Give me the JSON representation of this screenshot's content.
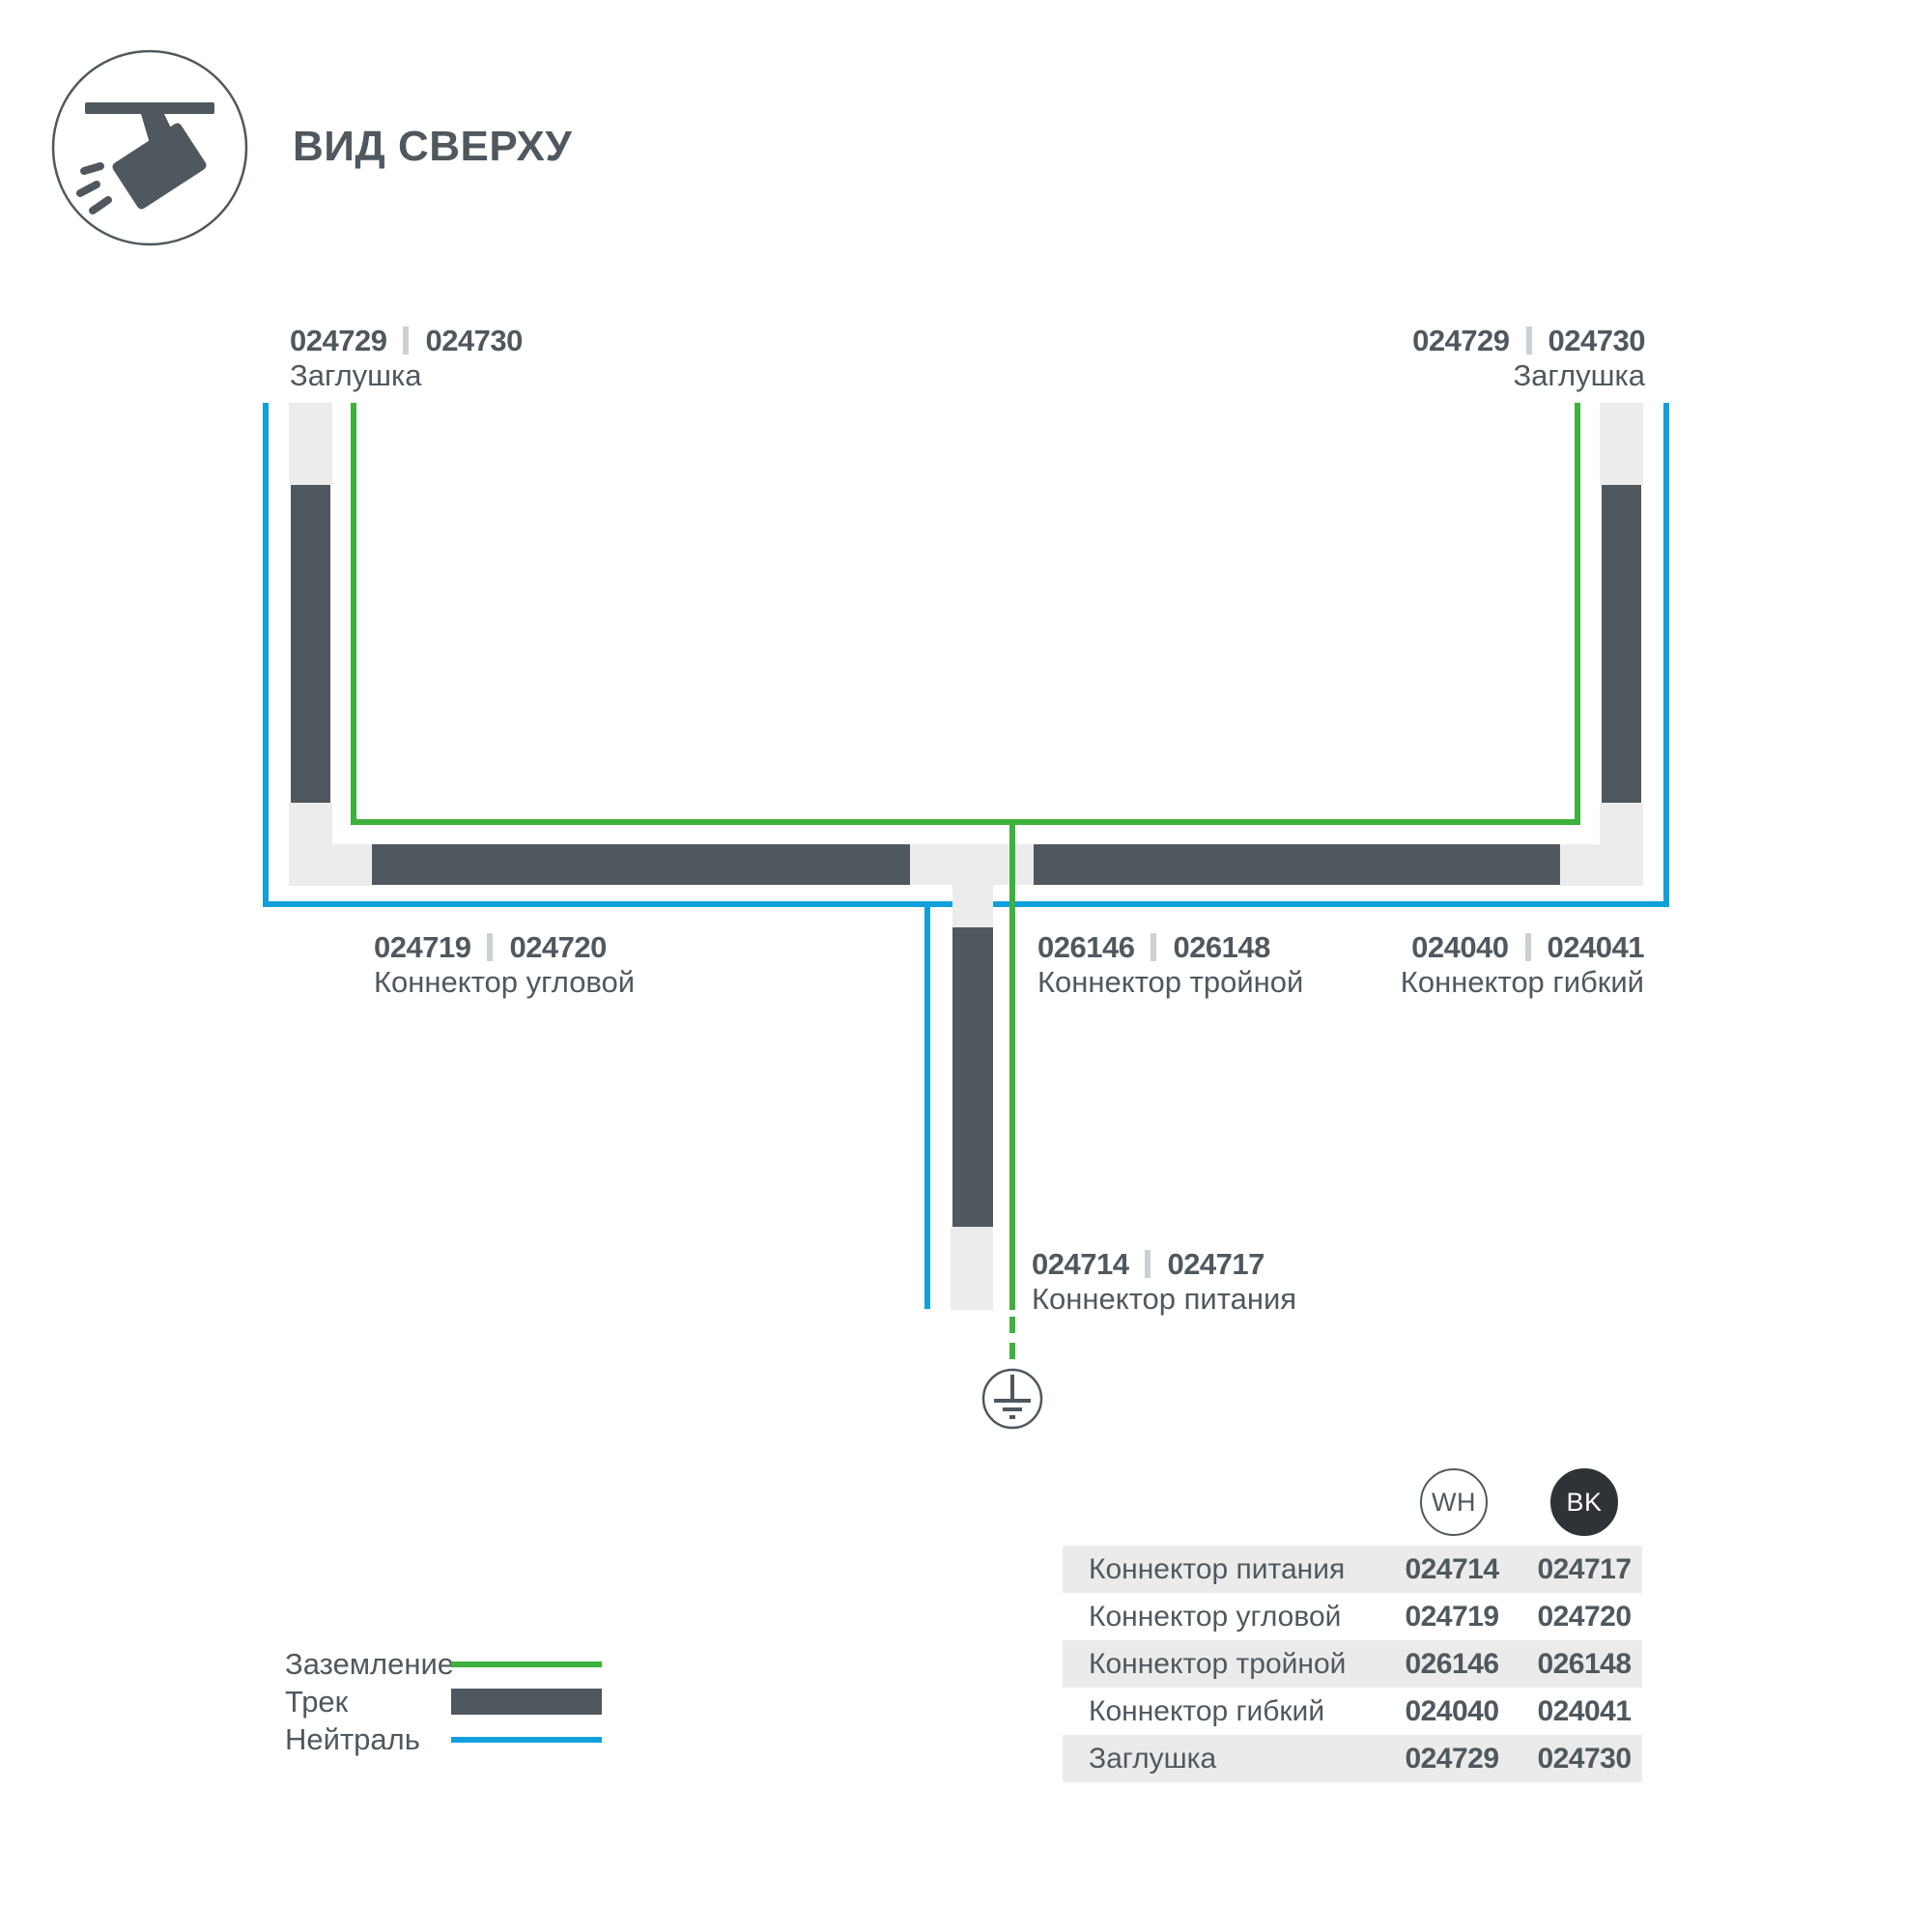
{
  "header": {
    "title": "ВИД СВЕРХУ",
    "icon": "track-spotlight-icon"
  },
  "colors": {
    "dark": "#4f585e",
    "green": "#3cb13c",
    "blue": "#12a0db",
    "light_piece": "#ececed",
    "table_band": "#ebebeb",
    "separator": "#cbd0d3",
    "bk_badge": "#2f3337"
  },
  "diagram": {
    "labels": {
      "cap_left": {
        "code_wh": "024729",
        "code_bk": "024730",
        "name": "Заглушка"
      },
      "cap_right": {
        "code_wh": "024729",
        "code_bk": "024730",
        "name": "Заглушка"
      },
      "corner": {
        "code_wh": "024719",
        "code_bk": "024720",
        "name": "Коннектор угловой"
      },
      "tee": {
        "code_wh": "026146",
        "code_bk": "026148",
        "name": "Коннектор тройной"
      },
      "flex": {
        "code_wh": "024040",
        "code_bk": "024041",
        "name": "Коннектор гибкий"
      },
      "power": {
        "code_wh": "024714",
        "code_bk": "024717",
        "name": "Коннектор питания"
      }
    },
    "ground_symbol": "earth-ground-icon"
  },
  "legend": {
    "items": [
      {
        "label": "Заземление",
        "swatch": "green-line",
        "color": "#3cb13c"
      },
      {
        "label": "Трек",
        "swatch": "dark-bar",
        "color": "#4f585e"
      },
      {
        "label": "Нейтраль",
        "swatch": "blue-line",
        "color": "#12a0db"
      }
    ]
  },
  "table": {
    "columns": [
      {
        "badge": "WH"
      },
      {
        "badge": "BK"
      }
    ],
    "rows": [
      {
        "name": "Коннектор питания",
        "wh": "024714",
        "bk": "024717"
      },
      {
        "name": "Коннектор угловой",
        "wh": "024719",
        "bk": "024720"
      },
      {
        "name": "Коннектор тройной",
        "wh": "026146",
        "bk": "026148"
      },
      {
        "name": "Коннектор гибкий",
        "wh": "024040",
        "bk": "024041"
      },
      {
        "name": "Заглушка",
        "wh": "024729",
        "bk": "024730"
      }
    ]
  }
}
